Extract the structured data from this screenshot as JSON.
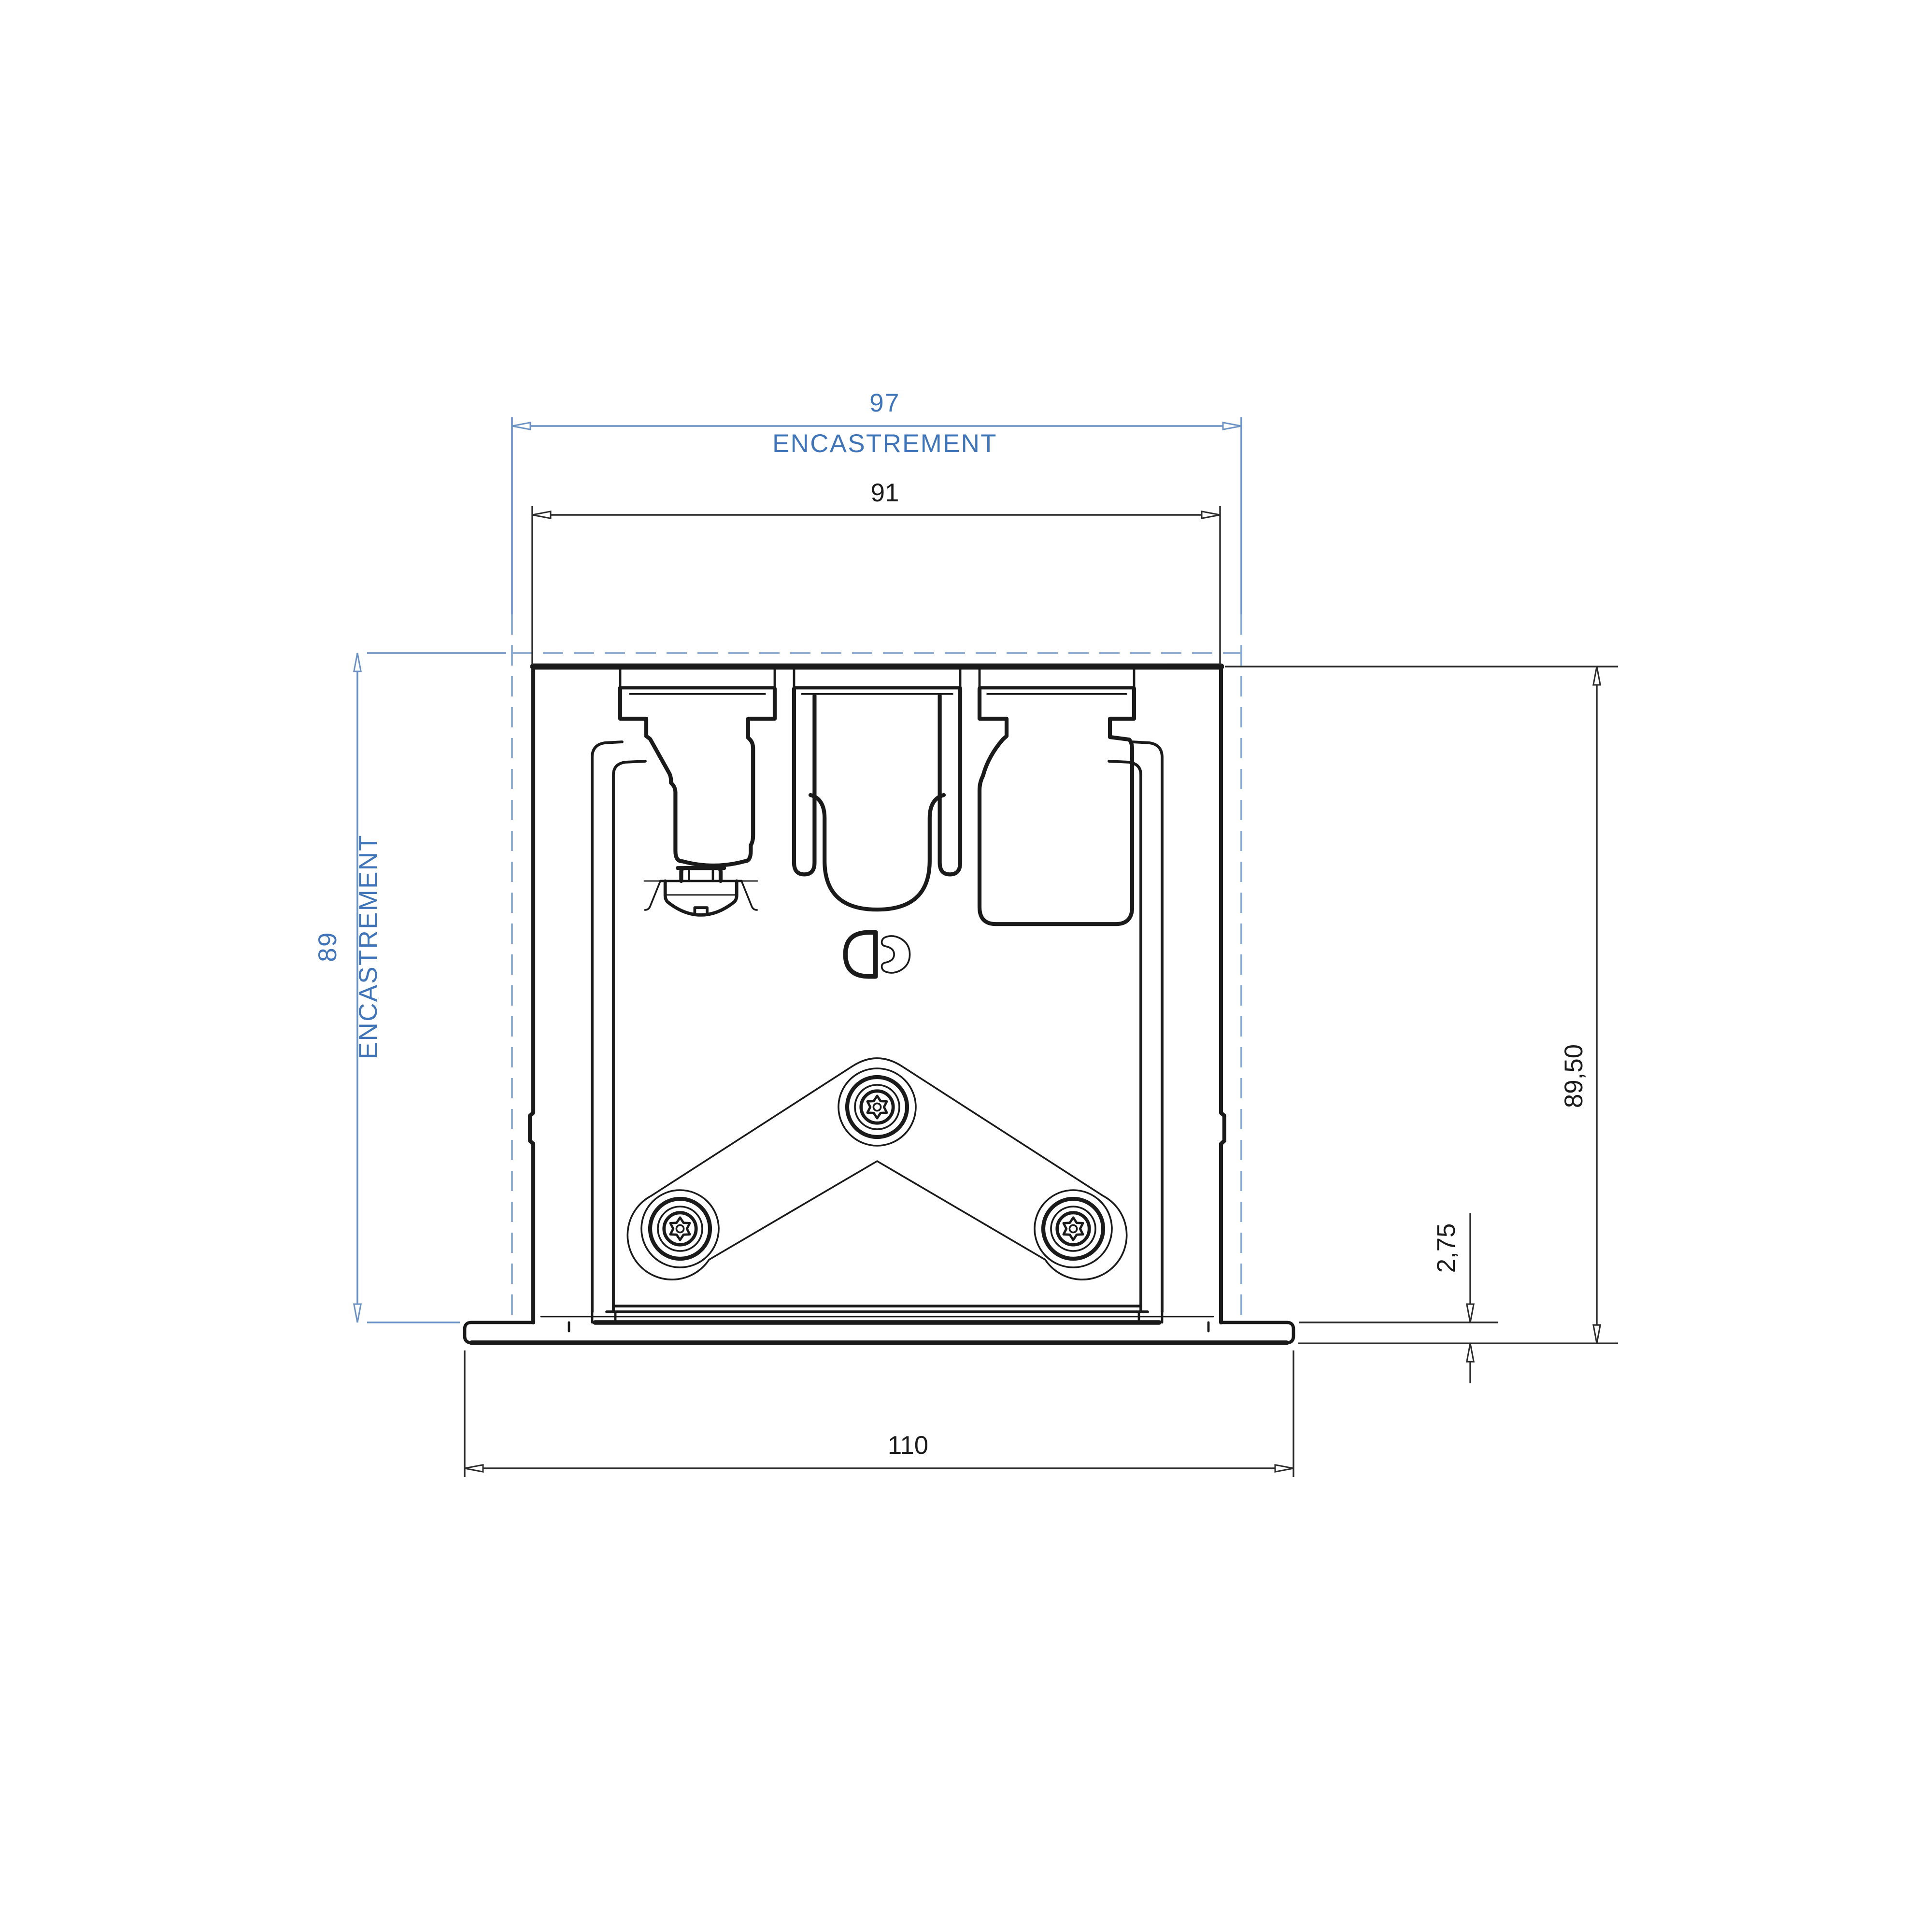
{
  "drawing": {
    "type": "technical-cross-section",
    "dimensions": {
      "recess_width": {
        "value": "97",
        "label": "ENCASTREMENT"
      },
      "body_width": {
        "value": "91"
      },
      "recess_depth": {
        "value": "89",
        "label": "ENCASTREMENT"
      },
      "overall_height": {
        "value": "89,50"
      },
      "flange_offset": {
        "value": "2,75"
      },
      "flange_width": {
        "value": "110"
      }
    },
    "colors": {
      "reference_blue_text": "#3f74b8",
      "reference_blue_line": "#6b92c4",
      "cutout_dash_blue": "#8aa9d2",
      "line_black": "#1a1a1a",
      "background": "#ffffff"
    }
  }
}
